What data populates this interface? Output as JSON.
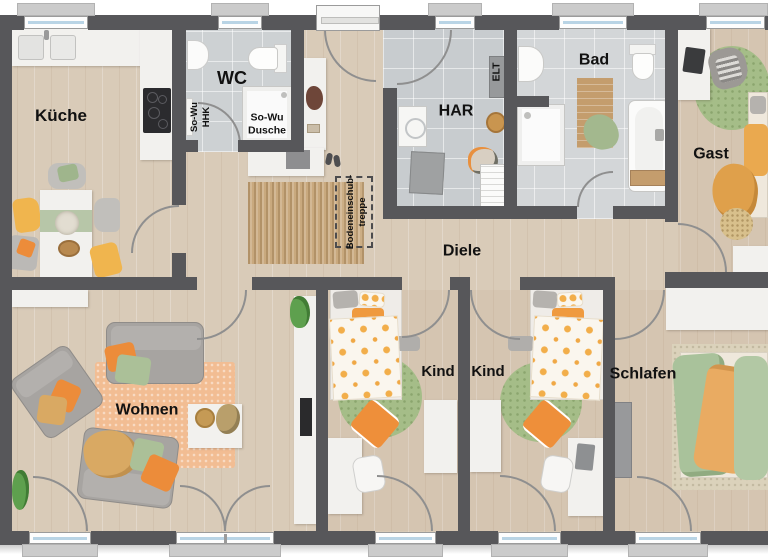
{
  "labels": {
    "kueche": "Küche",
    "wc": "WC",
    "har": "HAR",
    "bad": "Bad",
    "gast": "Gast",
    "diele": "Diele",
    "wohnen": "Wohnen",
    "kind_1": "Kind",
    "kind_2": "Kind",
    "schlafen": "Schlafen",
    "sowu_dusche_1": "So-Wu",
    "sowu_dusche_2": "Dusche",
    "sowu_hhk_1": "So-Wu",
    "sowu_hhk_2": "HHK",
    "elt": "ELT",
    "bodentreppe_1": "Bodeneinschub-",
    "bodentreppe_2": "treppe"
  },
  "colors": {
    "wall": "#57575a",
    "wood_floor": "#d9cbb8",
    "tile_floor": "#cdd1d3",
    "window_glass": "#b9d4e5",
    "accent_orange": "#ee953f",
    "accent_sage": "#a5bd88",
    "accent_tan": "#d9a963",
    "rug_living": "#f2bd93",
    "rug_jute": "#c9a97e"
  }
}
